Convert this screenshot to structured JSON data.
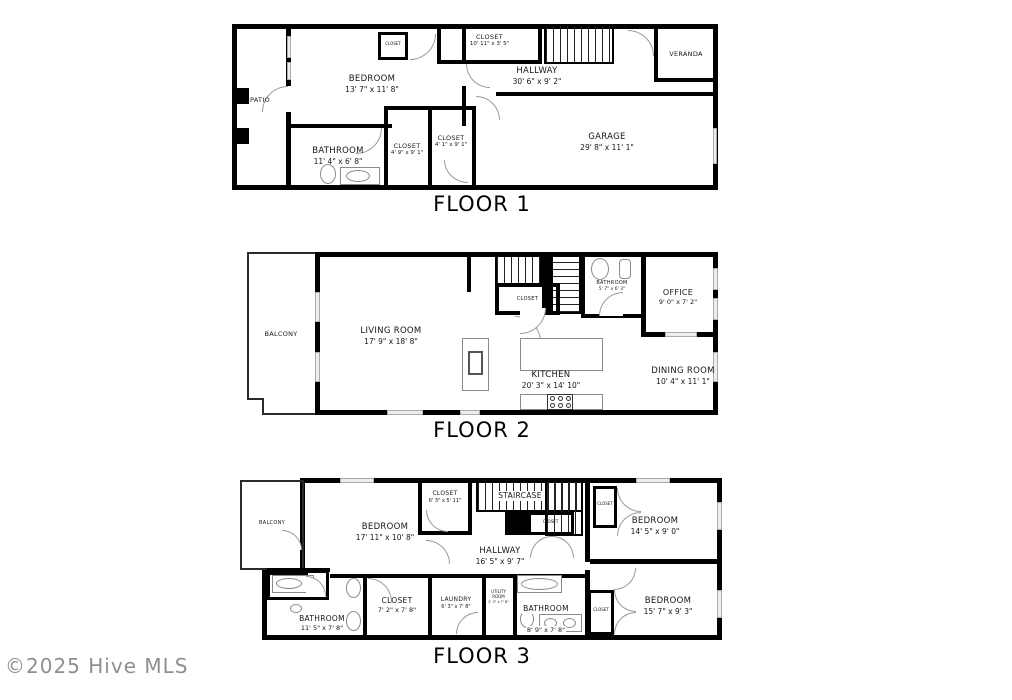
{
  "watermark": "©2025 Hive MLS",
  "floor1": {
    "title": "FLOOR 1",
    "patio": {
      "name": "PATIO"
    },
    "bedroom": {
      "name": "BEDROOM",
      "dims": "13' 7\" x 11' 8\""
    },
    "closet_entry": {
      "name": "CLOSET"
    },
    "closet_top": {
      "name": "CLOSET",
      "dims": "10' 11\" x 3' 5\""
    },
    "hallway": {
      "name": "HALLWAY",
      "dims": "30' 6\" x 9' 2\""
    },
    "veranda": {
      "name": "VERANDA"
    },
    "bathroom": {
      "name": "BATHROOM",
      "dims": "11' 4\" x 6' 8\""
    },
    "closet_a": {
      "name": "CLOSET",
      "dims": "4' 9\" x 9' 1\""
    },
    "closet_b": {
      "name": "CLOSET",
      "dims": "4' 1\" x 9' 1\""
    },
    "garage": {
      "name": "GARAGE",
      "dims": "29' 8\" x 11' 1\""
    }
  },
  "floor2": {
    "title": "FLOOR 2",
    "balcony": {
      "name": "BALCONY"
    },
    "living_room": {
      "name": "LIVING ROOM",
      "dims": "17' 9\" x 18' 8\""
    },
    "closet": {
      "name": "CLOSET"
    },
    "bathroom": {
      "name": "BATHROOM",
      "dims": "5' 7\" x 6' 3\""
    },
    "office": {
      "name": "OFFICE",
      "dims": "9' 0\" x 7' 2\""
    },
    "kitchen": {
      "name": "KITCHEN",
      "dims": "20' 3\" x 14' 10\""
    },
    "dining_room": {
      "name": "DINING ROOM",
      "dims": "10' 4\" x 11' 1\""
    }
  },
  "floor3": {
    "title": "FLOOR 3",
    "balcony": {
      "name": "BALCONY"
    },
    "bedroom_left": {
      "name": "BEDROOM",
      "dims": "17' 11\" x 10' 8\""
    },
    "closet_top": {
      "name": "CLOSET",
      "dims": "6' 3\" x 5' 11\""
    },
    "staircase": {
      "name": "STAIRCASE"
    },
    "closet_stairs": {
      "name": "CLOSET"
    },
    "closet_tr": {
      "name": "CLOSET"
    },
    "bedroom_right": {
      "name": "BEDROOM",
      "dims": "14' 5\" x 9' 0\""
    },
    "hallway": {
      "name": "HALLWAY",
      "dims": "16' 5\" x 9' 7\""
    },
    "bathroom_left": {
      "name": "BATHROOM",
      "dims": "11' 5\" x 7' 8\""
    },
    "closet_mid": {
      "name": "CLOSET",
      "dims": "7' 2\" x 7' 8\""
    },
    "laundry": {
      "name": "LAUNDRY",
      "dims": "6' 3\" x 7' 8\""
    },
    "utility": {
      "name": "UTILITY ROOM",
      "dims": "2' 3\" x 7' 8\""
    },
    "bathroom_mid": {
      "name": "BATHROOM",
      "dims": "8' 9\" x 7' 8\""
    },
    "closet_br": {
      "name": "CLOSET"
    },
    "bedroom_bottom": {
      "name": "BEDROOM",
      "dims": "15' 7\" x 9' 3\""
    }
  }
}
